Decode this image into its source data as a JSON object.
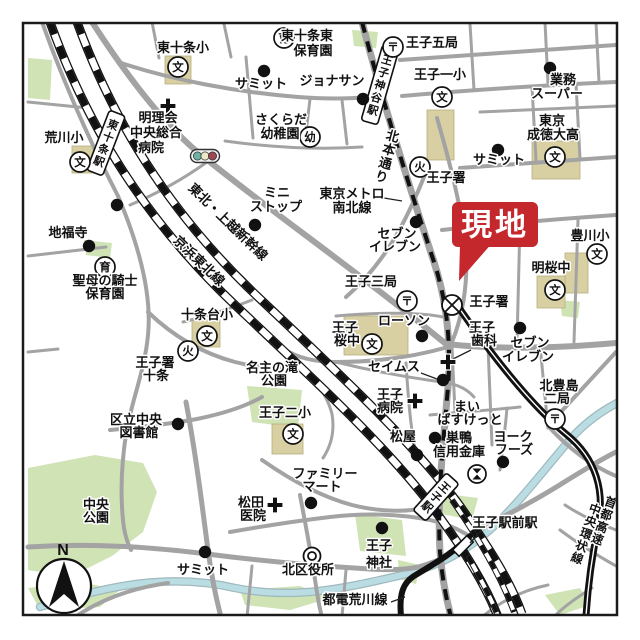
{
  "site_marker": {
    "label": "現地",
    "color": "#c4272c",
    "text_color": "#ffffff",
    "box": {
      "x": 452,
      "y": 202,
      "w": 86,
      "h": 45
    },
    "pointer": "460,244 493,242 459,281"
  },
  "compass": {
    "label": "N",
    "cx": 64,
    "cy": 586,
    "r": 27
  },
  "colors": {
    "border": "#1a1a1a",
    "road": "#a3a3a3",
    "park": "#cfe3b5",
    "building": "#d8d0a2",
    "river_fill": "#b9dde2",
    "river_casing": "#9fb9bd",
    "rail": "#111111",
    "label": "#111111",
    "halo": "#ffffff"
  },
  "glyphs": {
    "school": "文",
    "post": "〒",
    "fire": "火",
    "nursery": "育",
    "kindergarten": "幼"
  },
  "traffic_light": {
    "x": 205,
    "y": 156,
    "lamp_colors": [
      "#6db3a4",
      "#ece9c6",
      "#9c4752"
    ]
  },
  "stations": [
    {
      "label": "東十条駅",
      "cx": 106,
      "cy": 143,
      "rot": 21,
      "w": 17,
      "h": 64
    },
    {
      "label": "王子神谷駅",
      "cx": 380,
      "cy": 85,
      "rot": 16,
      "w": 17,
      "h": 78
    },
    {
      "label": "王子駅",
      "cx": 436,
      "cy": 497,
      "rot": 42,
      "w": 17,
      "h": 50
    }
  ],
  "tram_station_box": {
    "cx": 463,
    "cy": 546,
    "rot": 45,
    "w": 9,
    "h": 20
  },
  "labels": [
    {
      "t": "東十条小",
      "x": 183,
      "y": 52
    },
    {
      "t": "サミット",
      "x": 261,
      "y": 88
    },
    {
      "t": "ジョナサン",
      "x": 332,
      "y": 85
    },
    {
      "t": "東十条東",
      "x": 307,
      "y": 40
    },
    {
      "t": "保育園",
      "x": 313,
      "y": 55
    },
    {
      "t": "王子五局",
      "x": 432,
      "y": 47
    },
    {
      "t": "王子一小",
      "x": 440,
      "y": 79
    },
    {
      "t": "業務",
      "x": 563,
      "y": 84
    },
    {
      "t": "スーパー",
      "x": 557,
      "y": 98
    },
    {
      "t": "東京",
      "x": 552,
      "y": 125
    },
    {
      "t": "成徳大高",
      "x": 553,
      "y": 139
    },
    {
      "t": "明理会",
      "x": 158,
      "y": 122
    },
    {
      "t": "中央総合",
      "x": 156,
      "y": 137
    },
    {
      "t": "病院",
      "x": 151,
      "y": 152
    },
    {
      "t": "荒川小",
      "x": 64,
      "y": 142
    },
    {
      "t": "さくらだ",
      "x": 281,
      "y": 124
    },
    {
      "t": "幼稚園",
      "x": 280,
      "y": 138
    },
    {
      "t": "サミット",
      "x": 499,
      "y": 164
    },
    {
      "t": "王子署",
      "x": 446,
      "y": 182
    },
    {
      "t": "ミニ",
      "x": 277,
      "y": 197
    },
    {
      "t": "ストップ",
      "x": 276,
      "y": 211
    },
    {
      "t": "東京メトロ",
      "x": 352,
      "y": 198
    },
    {
      "t": "南北線",
      "x": 352,
      "y": 212
    },
    {
      "t": "セブン",
      "x": 397,
      "y": 238
    },
    {
      "t": "イレブン",
      "x": 395,
      "y": 251
    },
    {
      "t": "地福寺",
      "x": 68,
      "y": 237
    },
    {
      "t": "豊川小",
      "x": 590,
      "y": 240
    },
    {
      "t": "明桜中",
      "x": 551,
      "y": 272
    },
    {
      "t": "聖母の騎士",
      "x": 105,
      "y": 285
    },
    {
      "t": "保育園",
      "x": 105,
      "y": 298
    },
    {
      "t": "王子三局",
      "x": 371,
      "y": 286
    },
    {
      "t": "王子署",
      "x": 489,
      "y": 306
    },
    {
      "t": "十条台小",
      "x": 207,
      "y": 319
    },
    {
      "t": "王子",
      "x": 345,
      "y": 332
    },
    {
      "t": "桜中",
      "x": 347,
      "y": 345
    },
    {
      "t": "ローソン",
      "x": 404,
      "y": 325
    },
    {
      "t": "セブン",
      "x": 530,
      "y": 347
    },
    {
      "t": "イレブン",
      "x": 528,
      "y": 361
    },
    {
      "t": "王子",
      "x": 482,
      "y": 332
    },
    {
      "t": "歯科",
      "x": 484,
      "y": 345
    },
    {
      "t": "セイムス",
      "x": 394,
      "y": 371
    },
    {
      "t": "王子",
      "x": 390,
      "y": 399
    },
    {
      "t": "病院",
      "x": 390,
      "y": 412
    },
    {
      "t": "名主の滝",
      "x": 272,
      "y": 372
    },
    {
      "t": "公園",
      "x": 274,
      "y": 385
    },
    {
      "t": "王子二小",
      "x": 285,
      "y": 417
    },
    {
      "t": "北豊島",
      "x": 559,
      "y": 390
    },
    {
      "t": "二局",
      "x": 557,
      "y": 403
    },
    {
      "t": "まい",
      "x": 467,
      "y": 411
    },
    {
      "t": "ばすけっと",
      "x": 470,
      "y": 424
    },
    {
      "t": "ヨーク",
      "x": 513,
      "y": 441
    },
    {
      "t": "フーズ",
      "x": 514,
      "y": 454
    },
    {
      "t": "巣鴨",
      "x": 459,
      "y": 442
    },
    {
      "t": "信用金庫",
      "x": 459,
      "y": 456
    },
    {
      "t": "松屋",
      "x": 403,
      "y": 441
    },
    {
      "t": "区立中央",
      "x": 136,
      "y": 424
    },
    {
      "t": "図書館",
      "x": 139,
      "y": 437
    },
    {
      "t": "ファミリー",
      "x": 325,
      "y": 478
    },
    {
      "t": "マート",
      "x": 322,
      "y": 491
    },
    {
      "t": "松田",
      "x": 251,
      "y": 507
    },
    {
      "t": "医院",
      "x": 253,
      "y": 520
    },
    {
      "t": "中央",
      "x": 96,
      "y": 509
    },
    {
      "t": "公園",
      "x": 96,
      "y": 522
    },
    {
      "t": "王子駅前駅",
      "x": 505,
      "y": 527
    },
    {
      "t": "王子",
      "x": 379,
      "y": 550
    },
    {
      "t": "神社",
      "x": 379,
      "y": 567
    },
    {
      "t": "サミット",
      "x": 203,
      "y": 574
    },
    {
      "t": "北区役所",
      "x": 308,
      "y": 574
    },
    {
      "t": "都電荒川線",
      "x": 355,
      "y": 604
    },
    {
      "t": "王子署",
      "x": 155,
      "y": 367
    },
    {
      "t": "十条",
      "x": 156,
      "y": 380
    }
  ],
  "rotated_labels": [
    {
      "t": "北本通り",
      "x": 387,
      "y": 157,
      "rot": 15,
      "vertical": true,
      "size": 13
    },
    {
      "t": "東北・上越新幹線",
      "x": 225,
      "y": 225,
      "rot": 44,
      "size": 13
    },
    {
      "t": "京浜東北線",
      "x": 196,
      "y": 264,
      "rot": 44,
      "size": 13
    },
    {
      "t": "首都高速",
      "x": 604,
      "y": 521,
      "rot": 20,
      "vertical": true,
      "size": 12
    },
    {
      "t": "中央環状線",
      "x": 586,
      "y": 534,
      "rot": 20,
      "vertical": true,
      "size": 12
    }
  ],
  "symbols": {
    "schools": [
      [
        178,
        67
      ],
      [
        80,
        162
      ],
      [
        442,
        97
      ],
      [
        555,
        157
      ],
      [
        597,
        254
      ],
      [
        555,
        290
      ],
      [
        372,
        344
      ],
      [
        207,
        336
      ],
      [
        293,
        434
      ]
    ],
    "post_offices": [
      [
        393,
        47
      ],
      [
        407,
        301
      ],
      [
        555,
        419
      ]
    ],
    "fire_stations": [
      [
        420,
        167
      ],
      [
        188,
        351
      ]
    ],
    "police_stations": [
      [
        452,
        305
      ]
    ],
    "nurseries": [
      [
        284,
        38
      ],
      [
        105,
        267
      ]
    ],
    "kindergartens": [
      [
        310,
        137
      ]
    ],
    "ward_offices": [
      [
        312,
        556
      ]
    ],
    "hospitals": [
      [
        168,
        106
      ],
      [
        275,
        505
      ],
      [
        415,
        401
      ],
      [
        448,
        362
      ]
    ],
    "banks": [
      [
        477,
        474
      ]
    ],
    "dots": [
      [
        264,
        71
      ],
      [
        363,
        99
      ],
      [
        550,
        68
      ],
      [
        498,
        150
      ],
      [
        416,
        222
      ],
      [
        255,
        225
      ],
      [
        117,
        205
      ],
      [
        89,
        246
      ],
      [
        422,
        336
      ],
      [
        520,
        328
      ],
      [
        443,
        380
      ],
      [
        417,
        455
      ],
      [
        435,
        438
      ],
      [
        503,
        462
      ],
      [
        178,
        424
      ],
      [
        311,
        503
      ],
      [
        205,
        552
      ],
      [
        382,
        528
      ]
    ]
  },
  "geometry": {
    "parks": [
      "28,468 95,455 143,463 157,492 143,532 112,556 70,577 28,570",
      "247,386 302,390 298,428 252,422",
      "355,514 402,520 406,556 360,551",
      "28,58 52,60 50,100 28,98",
      "84,240 112,243 110,258 86,255",
      "352,30 378,32 376,48 354,46",
      "430,492 478,498 472,520 432,512",
      "560,300 580,302 578,318 562,316",
      "28,588 80,582 120,590 100,607 40,610",
      "240,590 300,586 330,598 290,610 245,605",
      "545,595 580,588 590,605 560,615",
      "398,560 420,565 416,584 399,579"
    ],
    "buildings": [
      [
        165,
        56,
        26,
        28
      ],
      [
        72,
        146,
        34,
        27
      ],
      [
        427,
        110,
        27,
        50
      ],
      [
        532,
        141,
        48,
        38
      ],
      [
        565,
        253,
        23,
        40
      ],
      [
        537,
        276,
        28,
        32
      ],
      [
        344,
        316,
        64,
        39
      ],
      [
        192,
        320,
        28,
        27
      ],
      [
        272,
        424,
        31,
        30
      ]
    ],
    "river": "M 40,607 C 110,585 170,573 235,588 C 295,600 345,588 398,576 C 440,566 465,552 492,528 C 520,502 548,465 568,442 C 583,424 600,412 617,403",
    "roads": [
      {
        "d": "M 42,22 C 62,78 88,138 118,196",
        "w": 4
      },
      {
        "d": "M 92,22 C 132,84 172,134 210,162 C 272,212 358,272 446,344",
        "w": 6
      },
      {
        "d": "M 118,62 C 172,80 236,92 298,97 C 324,99 348,99 368,97",
        "w": 4
      },
      {
        "d": "M 28,102 L 88,108",
        "w": 3
      },
      {
        "d": "M 152,22 L 159,58",
        "w": 3
      },
      {
        "d": "M 224,24 L 231,57",
        "w": 3
      },
      {
        "d": "M 246,57 L 253,138",
        "w": 3
      },
      {
        "d": "M 225,141 C 268,147 315,150 362,147",
        "w": 3
      },
      {
        "d": "M 310,99 L 305,141",
        "w": 3
      },
      {
        "d": "M 207,162 C 182,180 156,194 130,205",
        "w": 3
      },
      {
        "d": "M 342,100 L 347,144",
        "w": 3
      },
      {
        "d": "M 362,22 C 385,110 412,195 434,262 C 448,305 452,350 447,398 C 443,448 437,498 440,552 C 442,577 446,598 451,617",
        "w": 7
      },
      {
        "d": "M 400,60 C 462,56 540,50 616,45",
        "w": 4
      },
      {
        "d": "M 402,96 C 470,90 550,85 616,82",
        "w": 4
      },
      {
        "d": "M 470,24 L 474,90",
        "w": 3
      },
      {
        "d": "M 545,22 L 548,84",
        "w": 3
      },
      {
        "d": "M 596,22 L 599,82",
        "w": 3
      },
      {
        "d": "M 480,112 C 530,110 575,108 616,106",
        "w": 3
      },
      {
        "d": "M 532,86 L 536,160",
        "w": 3
      },
      {
        "d": "M 576,84 L 580,158",
        "w": 3
      },
      {
        "d": "M 460,168 C 520,164 572,160 616,157",
        "w": 4
      },
      {
        "d": "M 426,172 C 407,220 386,262 346,297",
        "w": 4
      },
      {
        "d": "M 437,118 C 452,170 463,215 466,252 C 468,285 462,318 452,342",
        "w": 4
      },
      {
        "d": "M 442,230 C 498,224 558,219 616,215",
        "w": 4
      },
      {
        "d": "M 520,222 L 517,342",
        "w": 3
      },
      {
        "d": "M 578,220 L 574,342",
        "w": 3
      },
      {
        "d": "M 446,344 C 500,350 560,348 616,343",
        "w": 6
      },
      {
        "d": "M 336,316 C 380,312 422,312 448,318",
        "w": 3
      },
      {
        "d": "M 448,347 C 410,358 370,362 336,362 C 312,362 296,357 284,349",
        "w": 4
      },
      {
        "d": "M 336,362 C 376,372 412,378 442,382 C 458,384 468,390 474,397",
        "w": 3
      },
      {
        "d": "M 406,363 C 408,395 410,422 415,450",
        "w": 3
      },
      {
        "d": "M 452,347 L 455,412",
        "w": 3
      },
      {
        "d": "M 488,346 L 492,445",
        "w": 3
      },
      {
        "d": "M 430,415 C 462,412 492,410 520,407",
        "w": 3
      },
      {
        "d": "M 540,345 L 548,428",
        "w": 3
      },
      {
        "d": "M 616,352 C 592,378 568,404 548,426",
        "w": 4
      },
      {
        "d": "M 548,426 C 570,450 592,466 616,476",
        "w": 4
      },
      {
        "d": "M 507,408 C 505,432 502,452 500,470",
        "w": 3
      },
      {
        "d": "M 118,196 C 140,248 152,295 148,335 C 145,368 133,398 127,428 C 122,458 120,490 123,520 C 124,532 127,542 131,550",
        "w": 4
      },
      {
        "d": "M 28,256 L 106,247",
        "w": 3
      },
      {
        "d": "M 28,352 L 58,349",
        "w": 3
      },
      {
        "d": "M 148,312 C 175,338 205,354 235,362 C 262,369 286,369 300,365",
        "w": 4
      },
      {
        "d": "M 300,365 C 318,382 328,398 332,414 C 335,432 331,446 323,458",
        "w": 3
      },
      {
        "d": "M 183,322 C 208,316 232,308 252,300",
        "w": 3
      },
      {
        "d": "M 110,430 C 142,427 170,424 197,419 C 226,413 248,405 262,397",
        "w": 4
      },
      {
        "d": "M 186,402 C 196,455 202,505 208,550 C 212,580 217,602 221,617",
        "w": 5
      },
      {
        "d": "M 28,547 C 95,543 150,547 207,554 C 262,561 318,566 370,569 C 402,571 420,568 436,562",
        "w": 5
      },
      {
        "d": "M 75,617 C 100,600 132,588 168,583",
        "w": 4
      },
      {
        "d": "M 262,460 C 292,481 322,497 352,505 C 380,512 406,512 426,508",
        "w": 4
      },
      {
        "d": "M 230,532 C 264,526 296,521 330,517 C 365,513 400,514 430,520 C 444,523 456,528 466,534",
        "w": 4
      },
      {
        "d": "M 300,495 C 305,522 311,552 316,586 C 318,600 320,610 322,617",
        "w": 4
      },
      {
        "d": "M 252,566 L 247,617",
        "w": 3
      },
      {
        "d": "M 346,570 L 342,617",
        "w": 3
      },
      {
        "d": "M 420,566 C 440,560 456,552 468,542",
        "w": 4
      },
      {
        "d": "M 472,532 C 502,518 532,502 558,486 C 582,471 600,460 616,452",
        "w": 5
      },
      {
        "d": "M 560,530 C 580,545 600,557 616,566",
        "w": 3
      },
      {
        "d": "M 592,588 C 576,598 562,608 554,617",
        "w": 3
      },
      {
        "d": "M 482,617 C 502,600 524,590 548,585",
        "w": 3
      },
      {
        "d": "M 565,505 C 580,515 600,524 616,530",
        "w": 3
      }
    ],
    "jr_lines": [
      "M 50,22 C 85,120 140,215 235,305 C 320,385 392,452 436,512 C 466,553 486,586 498,617",
      "M 77,22 C 112,118 166,210 258,297 C 343,377 416,446 460,506 C 489,548 510,580 522,614"
    ],
    "jr_stubs": [
      "M 452,500 C 478,538 500,574 514,612",
      "M 468,556 C 480,578 491,598 498,616"
    ],
    "subway": "M 362,22 C 385,110 412,195 434,262 C 448,305 452,350 447,398 C 443,448 437,498 440,552 C 442,577 446,598 451,617",
    "tram": "M 470,536 C 450,556 430,566 414,576 C 403,583 399,594 401,616",
    "expressway": "M 455,302 C 492,356 532,406 566,434 C 597,459 605,492 598,527 C 592,556 588,585 586,616",
    "connectors": [
      "M 384,198 L 402,201",
      "M 471,350 L 453,359",
      "M 421,373 L 437,379",
      "M 481,531 L 470,543",
      "M 391,602 L 405,597"
    ]
  }
}
